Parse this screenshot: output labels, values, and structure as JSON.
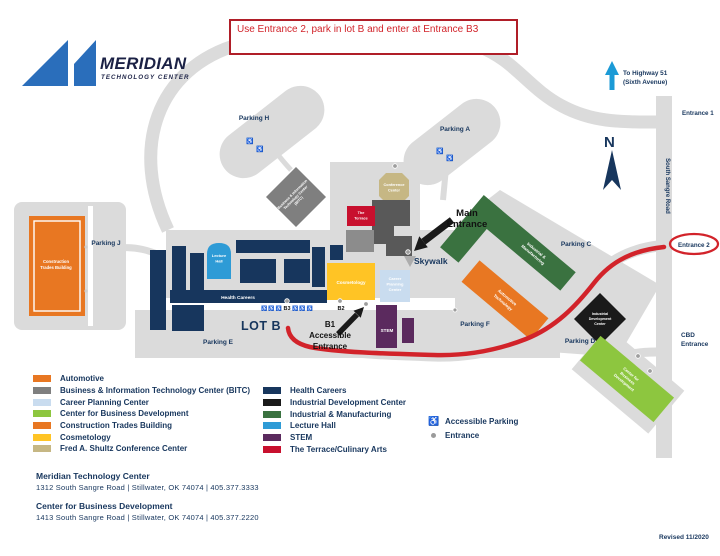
{
  "annotation": "Use Entrance 2, park in lot B and enter at Entrance B3",
  "logo": {
    "title": "MERIDIAN",
    "subtitle": "TECHNOLOGY CENTER"
  },
  "map": {
    "north": "N",
    "highway": [
      "To Highway 51",
      "(Sixth Avenue)"
    ],
    "road": "South Sangre Road",
    "entrance1": "Entrance 1",
    "entrance2": "Entrance 2",
    "cbd_entrance": [
      "CBD",
      "Entrance"
    ],
    "lot_b": "LOT B",
    "parking": {
      "h": "Parking H",
      "a": "Parking A",
      "j": "Parking J",
      "c": "Parking C",
      "f": "Parking F",
      "d": "Parking D",
      "e": "Parking E"
    },
    "main_entrance": [
      "Main",
      "Entrance"
    ],
    "skywalk": "Skywalk",
    "b1": [
      "B1",
      "Accessible",
      "Entrance"
    ],
    "b2": "B2",
    "b3": "B3",
    "accessible_icons": "♿♿♿",
    "buildings": {
      "construction": [
        "Construction",
        "Trades Building"
      ],
      "bitc": [
        "Business & Information",
        "Technology Center",
        "(BITC)"
      ],
      "conference": [
        "Conference",
        "Center"
      ],
      "terrace": [
        "The",
        "Terrace"
      ],
      "lecture": [
        "Lecture",
        "Hall"
      ],
      "health": "Health Careers",
      "cosmetology": "Cosmetology",
      "career": [
        "Career",
        "Planning",
        "Center"
      ],
      "stem": "STEM",
      "industrial_mfg": [
        "Industrial &",
        "Manufacturing"
      ],
      "automotive": [
        "Automotive",
        "Technology"
      ],
      "idc": [
        "Industrial",
        "Development",
        "Center"
      ],
      "cbd": [
        "Center for",
        "Business",
        "Development"
      ]
    }
  },
  "legend": {
    "col1": [
      {
        "label": "Automotive",
        "color": "#E87722"
      },
      {
        "label": "Business & Information Technology Center (BITC)",
        "color": "#7F7F7F"
      },
      {
        "label": "Career Planning Center",
        "color": "#C9DCEF"
      },
      {
        "label": "Center for Business Development",
        "color": "#8DC63F"
      },
      {
        "label": "Construction Trades Building",
        "color": "#E87722"
      },
      {
        "label": "Cosmetology",
        "color": "#FFC425"
      },
      {
        "label": "Fred A. Shultz Conference Center",
        "color": "#C6B784"
      }
    ],
    "col2": [
      {
        "label": "Health Careers",
        "color": "#17365D"
      },
      {
        "label": "Industrial Development Center",
        "color": "#1A1A1A"
      },
      {
        "label": "Industrial & Manufacturing",
        "color": "#3A7240"
      },
      {
        "label": "Lecture Hall",
        "color": "#2E9BD6"
      },
      {
        "label": "STEM",
        "color": "#5B2A5E"
      },
      {
        "label": "The Terrace/Culinary Arts",
        "color": "#C8102E"
      }
    ],
    "symbols": [
      {
        "icon": "wheelchair",
        "label": "Accessible Parking"
      },
      {
        "icon": "dot",
        "label": "Entrance"
      }
    ]
  },
  "footer": {
    "locations": [
      {
        "name": "Meridian Technology Center",
        "detail": "1312 South Sangre Road   |   Stillwater, OK 74074   |   405.377.3333"
      },
      {
        "name": "Center for Business Development",
        "detail": "1413 South Sangre Road   |   Stillwater, OK 74074   |   405.377.2220"
      }
    ],
    "revised": "Revised 11/2020"
  },
  "colors": {
    "brand_blue": "#2A6EBB",
    "navy": "#17365D",
    "red_route": "#D2232A",
    "road_gray": "#DBDBDB",
    "orange": "#E87722",
    "building_gray": "#7F7F7F",
    "light_blue": "#C9DCEF",
    "light_green": "#8DC63F",
    "yellow": "#FFC425",
    "tan": "#C6B784",
    "black_bldg": "#1A1A1A",
    "green": "#3A7240",
    "cyan": "#2E9BD6",
    "purple": "#5B2A5E",
    "terrace_red": "#C8102E",
    "dark_gray": "#595959"
  }
}
